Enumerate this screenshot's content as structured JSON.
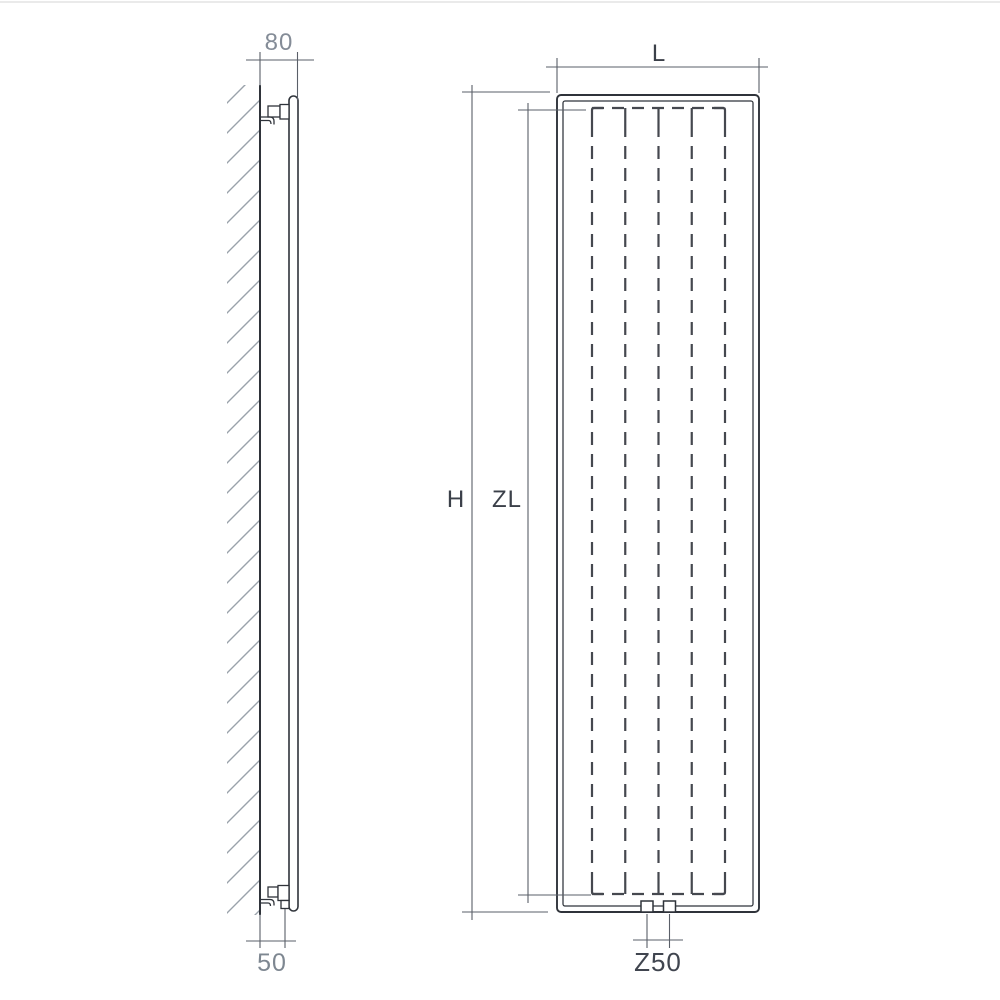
{
  "diagram": {
    "title": "vertical-radiator-dimension-drawing",
    "side_view": {
      "wall_clearance_top_label": "80",
      "pipe_offset_bottom_label": "50"
    },
    "front_view": {
      "width_label": "L",
      "height_label": "H",
      "collector_length_label": "ZL",
      "connection_spacing_label": "Z50"
    },
    "colors": {
      "outline_dark": "#2f333a",
      "dimension_line": "#5a5f68",
      "dashed_channel": "#45484f",
      "wall_hatch": "#9aa2ab",
      "label_gray": "#848c97",
      "label_dark": "#3b4049",
      "top_border": "#e3e3e3"
    }
  }
}
